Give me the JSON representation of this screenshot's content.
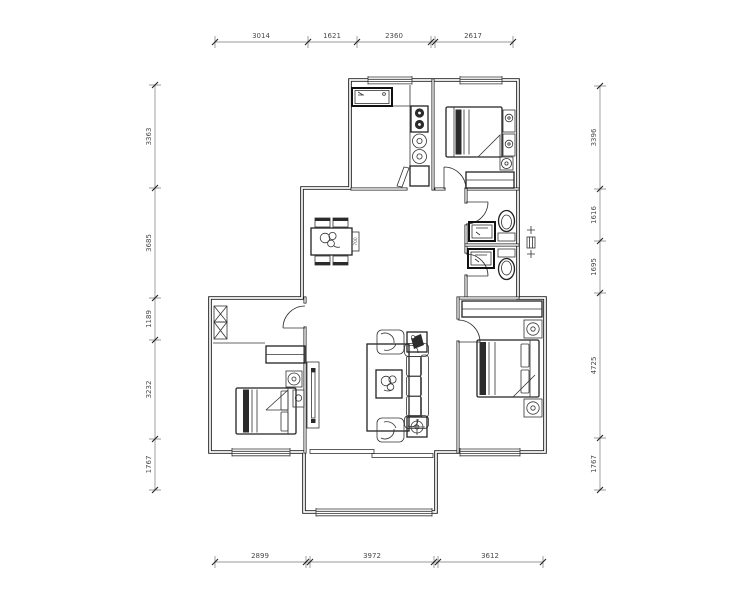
{
  "drawing": {
    "type": "apartment-floor-plan",
    "background": "#ffffff",
    "line_color": "#1b1b1b",
    "dim_text_color": "#4a4a4a"
  },
  "dimensions": {
    "top": [
      {
        "label": "3014"
      },
      {
        "label": "1621"
      },
      {
        "label": "2360"
      },
      {
        "label": "2617"
      }
    ],
    "left": [
      {
        "label": "3363"
      },
      {
        "label": "3685"
      },
      {
        "label": "1189"
      },
      {
        "label": "3232"
      },
      {
        "label": "1767"
      }
    ],
    "right": [
      {
        "label": "3396"
      },
      {
        "label": "1616"
      },
      {
        "label": "1695"
      },
      {
        "label": "4725"
      },
      {
        "label": "1767"
      }
    ],
    "bottom": [
      {
        "label": "2899"
      },
      {
        "label": "3972"
      },
      {
        "label": "3612"
      }
    ]
  },
  "annotations": {
    "table_label": "700"
  }
}
